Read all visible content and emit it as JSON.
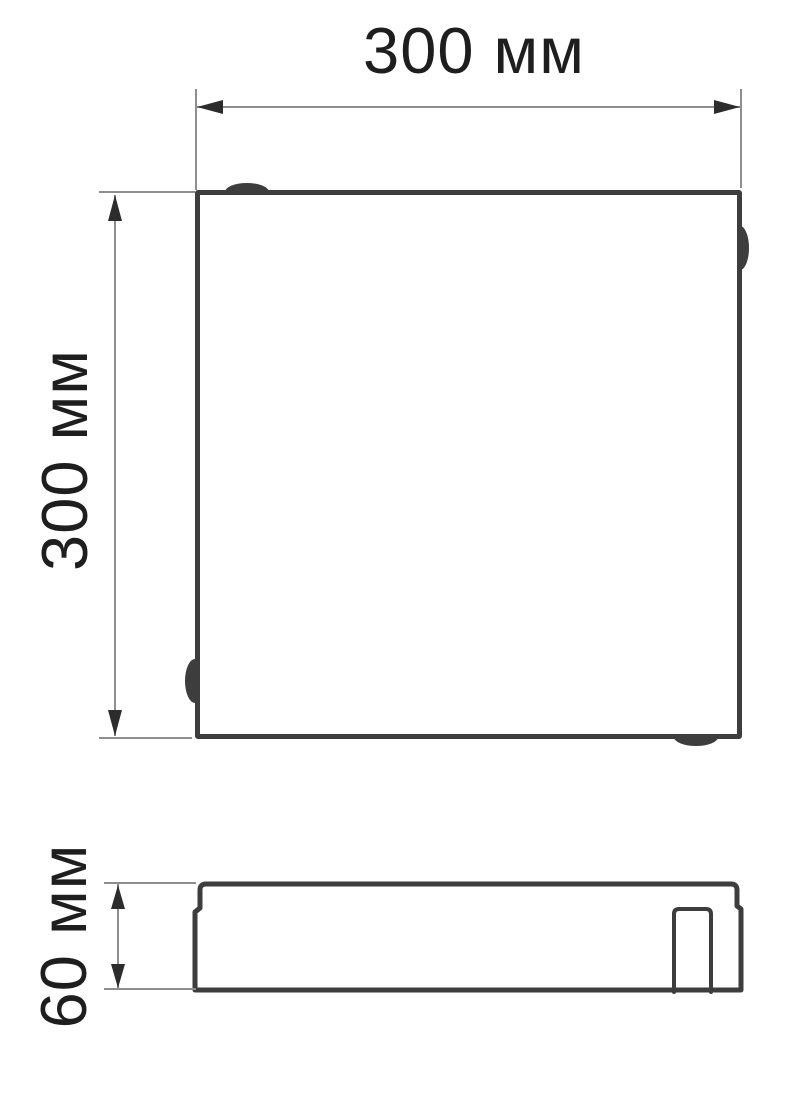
{
  "colors": {
    "outline": "#3d3d3d",
    "dim_line": "#8e8e8e",
    "arrow": "#2c2c2c",
    "text": "#1e1e1e",
    "background": "#ffffff"
  },
  "top_view": {
    "width_dimension": {
      "label": "300 мм"
    },
    "height_dimension": {
      "label": "300 мм"
    }
  },
  "side_view": {
    "height_dimension": {
      "label": "60 мм"
    }
  }
}
